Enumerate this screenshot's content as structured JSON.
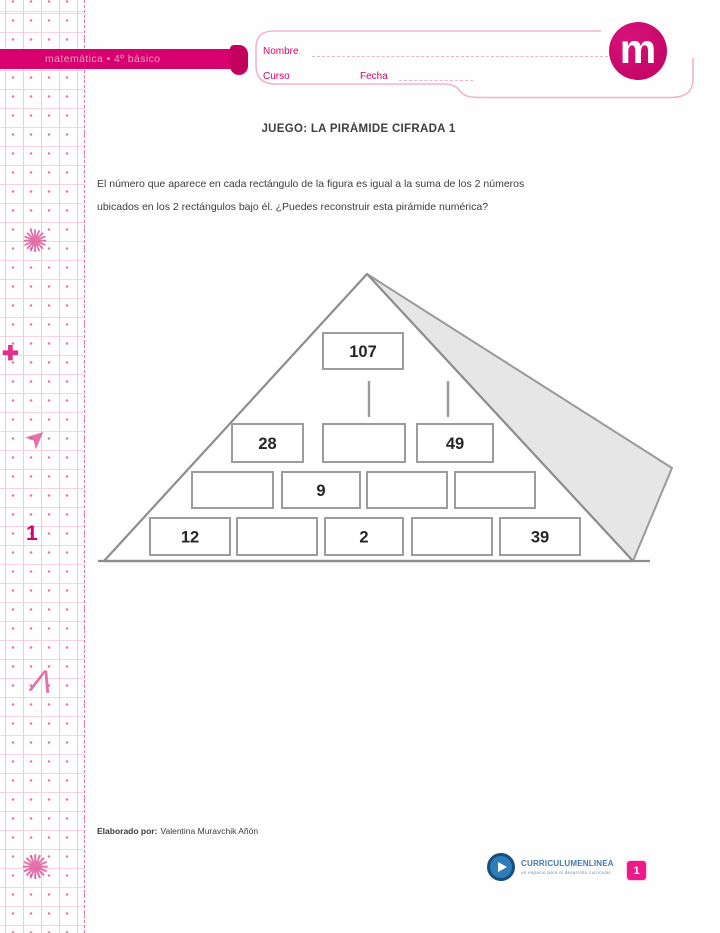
{
  "banner": {
    "text": "matemática • 4º básico"
  },
  "logo": {
    "letter": "m"
  },
  "form": {
    "name_label": "Nombre",
    "course_label": "Curso",
    "date_label": "Fecha"
  },
  "sidebar": {
    "unit_number": "1",
    "icons": [
      {
        "name": "pinwheel-icon",
        "glyph": "✺"
      },
      {
        "name": "plus-icon",
        "glyph": "✚"
      },
      {
        "name": "paper-plane-icon",
        "glyph": "➤"
      },
      {
        "name": "compass-icon",
        "glyph": "Λ"
      },
      {
        "name": "wheel-icon",
        "glyph": "✺"
      }
    ]
  },
  "worksheet": {
    "title": "JUEGO: LA PIRÁMIDE CIFRADA 1",
    "instructions_line1": "El número que aparece en cada rectángulo de la figura es igual a la suma de los 2 números",
    "instructions_line2": "ubicados en los 2 rectángulos bajo él. ¿Puedes reconstruir esta pirámide numérica?"
  },
  "pyramid": {
    "rows": [
      [
        "107"
      ],
      [
        "28",
        "",
        "49"
      ],
      [
        "",
        "9",
        "",
        ""
      ],
      [
        "12",
        "",
        "2",
        "",
        "39"
      ]
    ]
  },
  "footer": {
    "credit_label": "Elaborado por:",
    "credit_name": "Valentina Muravchik Añón",
    "brand": "CURRICULUMENLINEA",
    "brand_subtitle": "un espacio para el desarrollo curricular",
    "page_number": "1"
  },
  "colors": {
    "brand_magenta": "#d8006e",
    "accent_pink": "#e07ab0",
    "logo_blue": "#2e7cb8",
    "pyramid_shade": "#e6e6e6",
    "pyramid_line": "#8d8d8d"
  }
}
